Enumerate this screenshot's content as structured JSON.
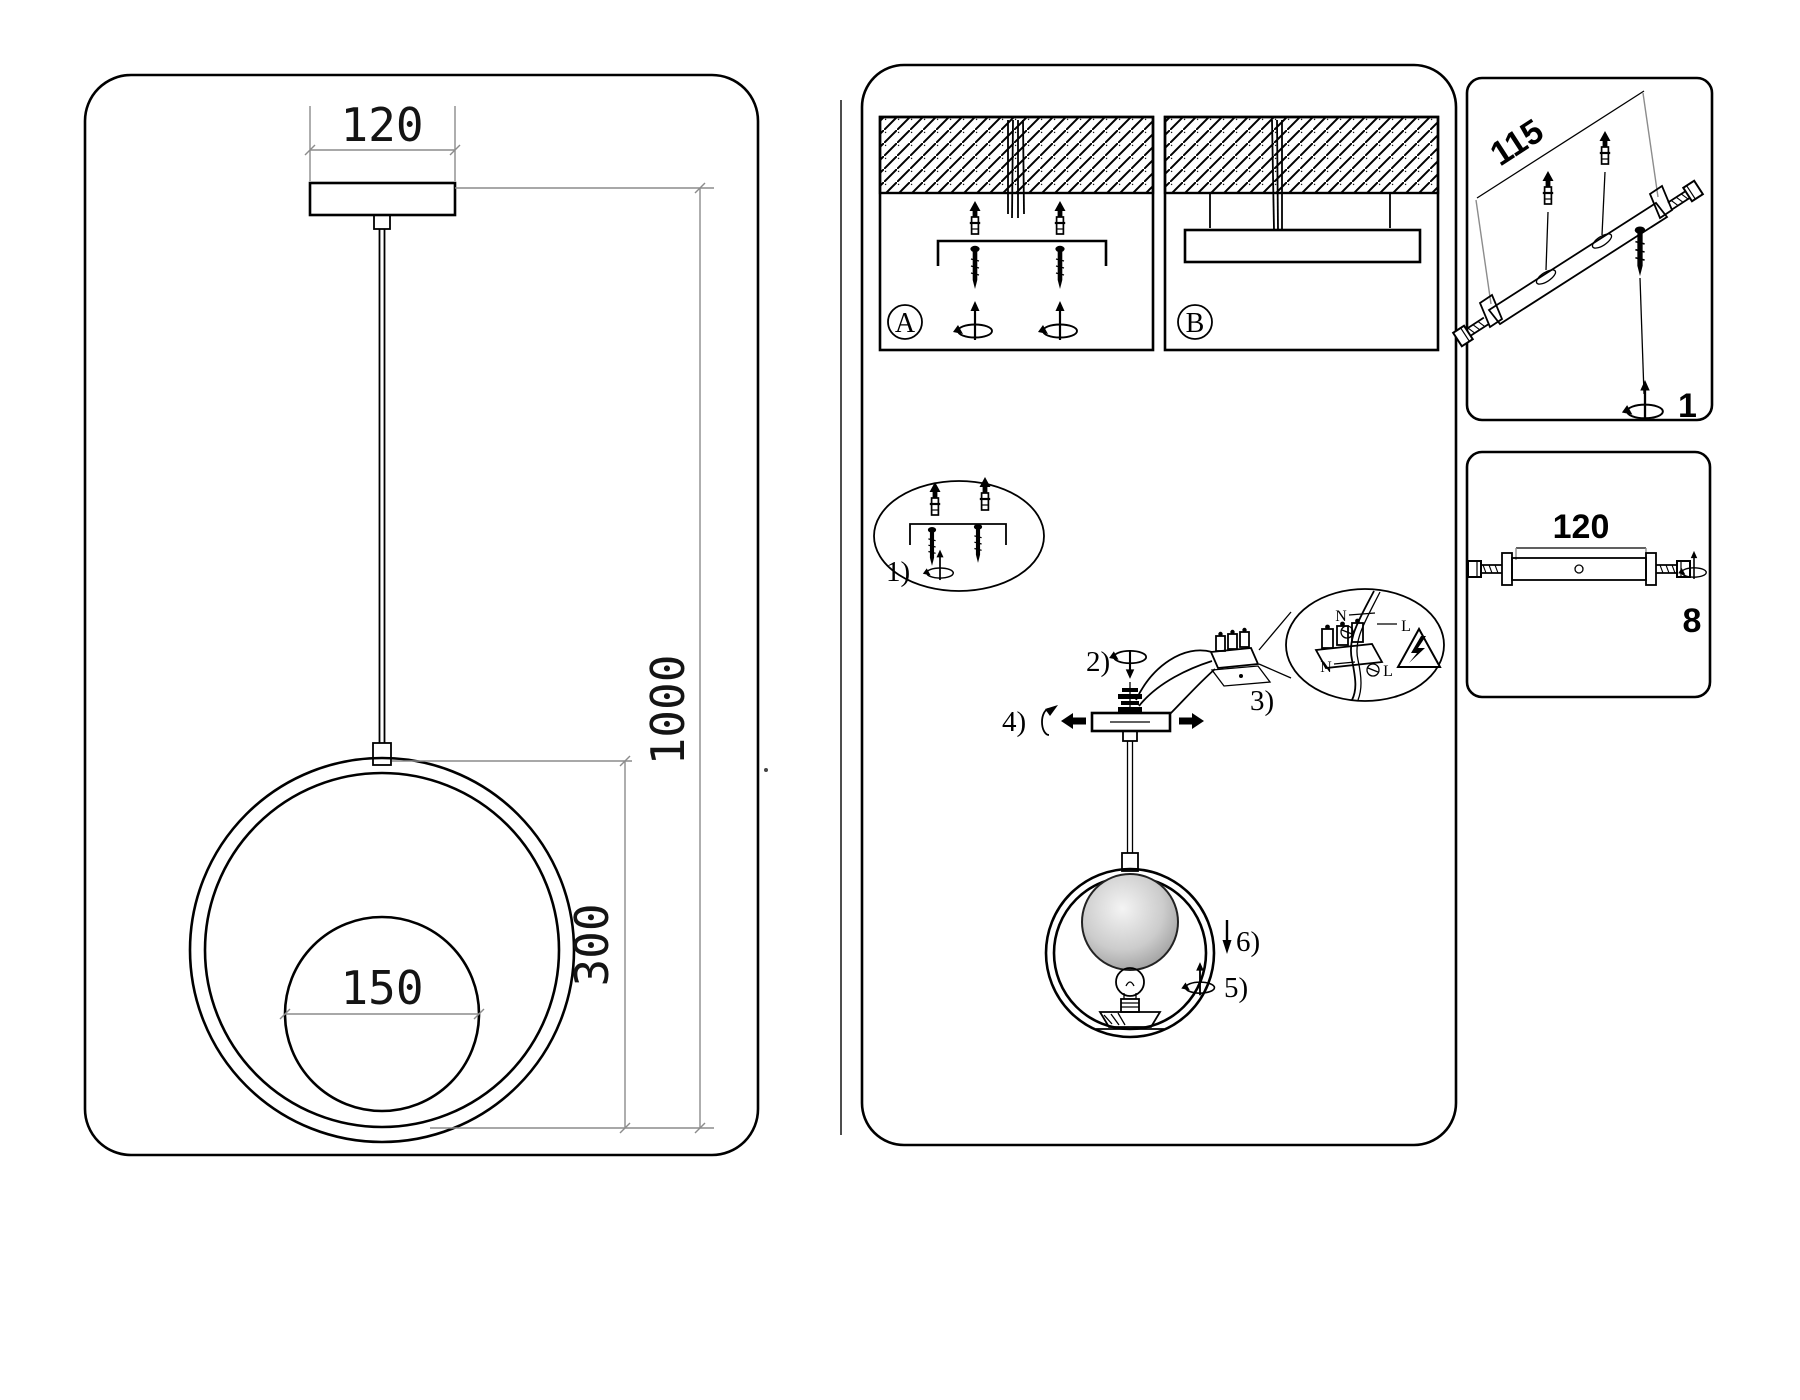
{
  "colors": {
    "background": "#ffffff",
    "line": "#000000",
    "dim_line": "#8c8c8c"
  },
  "icons": [
    "ceiling-hatch",
    "wall-plug-icon",
    "screw-icon",
    "rotation-arrow-icon",
    "block-arrow-icon",
    "lightning-warning-icon",
    "bulb-icon",
    "terminal-block-icon"
  ],
  "left_panel": {
    "dim_canopy_width": "120",
    "dim_total_height": "1000",
    "dim_ring_height": "300",
    "dim_globe_diameter": "150"
  },
  "middle_panel": {
    "option_a_label": "A",
    "option_b_label": "B",
    "step_labels": {
      "s1": "1)",
      "s2": "2)",
      "s3": "3)",
      "s4": "4)",
      "s5": "5)",
      "s6": "6)"
    },
    "wiring_detail": {
      "neutral_top": "N",
      "live_top": "L",
      "neutral_bottom": "N",
      "live_bottom": "L"
    }
  },
  "right_top_panel": {
    "dim_bracket_length": "115",
    "quantity": "1"
  },
  "right_bottom_panel": {
    "dim_bracket_length": "120",
    "quantity": "8"
  }
}
